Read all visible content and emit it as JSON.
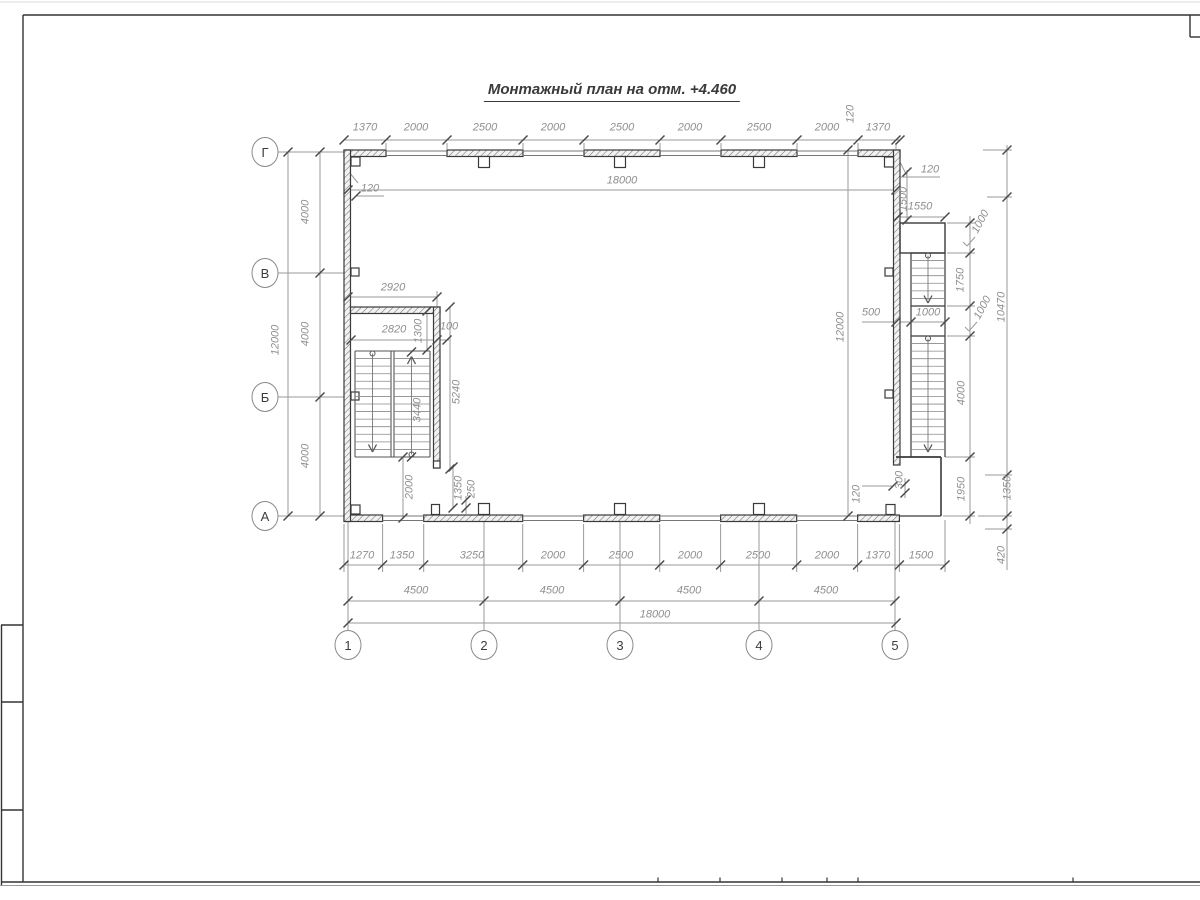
{
  "title": "Монтажный план на отм. +4.460",
  "grid": {
    "columns": [
      {
        "label": "1",
        "x": 348
      },
      {
        "label": "2",
        "x": 484
      },
      {
        "label": "3",
        "x": 620
      },
      {
        "label": "4",
        "x": 759
      },
      {
        "label": "5",
        "x": 895
      }
    ],
    "column_bubble_y": 645,
    "rows": [
      {
        "label": "Г",
        "y": 152
      },
      {
        "label": "В",
        "y": 273
      },
      {
        "label": "Б",
        "y": 397
      },
      {
        "label": "А",
        "y": 516
      }
    ],
    "row_bubble_x": 265
  },
  "dimensions": [
    {
      "text": "1370",
      "x": 365,
      "y": 128,
      "rot": 0
    },
    {
      "text": "2000",
      "x": 416,
      "y": 128,
      "rot": 0
    },
    {
      "text": "2500",
      "x": 485,
      "y": 128,
      "rot": 0
    },
    {
      "text": "2000",
      "x": 553,
      "y": 128,
      "rot": 0
    },
    {
      "text": "2500",
      "x": 622,
      "y": 128,
      "rot": 0
    },
    {
      "text": "2000",
      "x": 690,
      "y": 128,
      "rot": 0
    },
    {
      "text": "2500",
      "x": 759,
      "y": 128,
      "rot": 0
    },
    {
      "text": "2000",
      "x": 827,
      "y": 128,
      "rot": 0
    },
    {
      "text": "120",
      "x": 851,
      "y": 114,
      "rot": -90
    },
    {
      "text": "1370",
      "x": 878,
      "y": 128,
      "rot": 0
    },
    {
      "text": "120",
      "x": 370,
      "y": 189,
      "rot": 0
    },
    {
      "text": "18000",
      "x": 622,
      "y": 181,
      "rot": 0
    },
    {
      "text": "4000",
      "x": 306,
      "y": 212,
      "rot": -90
    },
    {
      "text": "4000",
      "x": 306,
      "y": 334,
      "rot": -90
    },
    {
      "text": "4000",
      "x": 306,
      "y": 456,
      "rot": -90
    },
    {
      "text": "12000",
      "x": 276,
      "y": 340,
      "rot": -90
    },
    {
      "text": "2920",
      "x": 393,
      "y": 288,
      "rot": 0
    },
    {
      "text": "2820",
      "x": 394,
      "y": 330,
      "rot": 0
    },
    {
      "text": "1300",
      "x": 419,
      "y": 331,
      "rot": -90
    },
    {
      "text": "100",
      "x": 449,
      "y": 327,
      "rot": 0
    },
    {
      "text": "5240",
      "x": 457,
      "y": 392,
      "rot": -90
    },
    {
      "text": "3440",
      "x": 418,
      "y": 410,
      "rot": -90
    },
    {
      "text": "2000",
      "x": 410,
      "y": 487,
      "rot": -90
    },
    {
      "text": "1350",
      "x": 459,
      "y": 488,
      "rot": -90
    },
    {
      "text": "250",
      "x": 472,
      "y": 489,
      "rot": -90
    },
    {
      "text": "12000",
      "x": 841,
      "y": 327,
      "rot": -90
    },
    {
      "text": "500",
      "x": 871,
      "y": 313,
      "rot": 0
    },
    {
      "text": "1000",
      "x": 928,
      "y": 313,
      "rot": 0
    },
    {
      "text": "120",
      "x": 930,
      "y": 170,
      "rot": 0
    },
    {
      "text": "1500",
      "x": 904,
      "y": 199,
      "rot": -90
    },
    {
      "text": "1550",
      "x": 920,
      "y": 207,
      "rot": 0
    },
    {
      "text": "1000",
      "x": 981,
      "y": 222,
      "rot": -62
    },
    {
      "text": "1750",
      "x": 961,
      "y": 280,
      "rot": -90
    },
    {
      "text": "1000",
      "x": 983,
      "y": 308,
      "rot": -62
    },
    {
      "text": "4000",
      "x": 962,
      "y": 393,
      "rot": -90
    },
    {
      "text": "1950",
      "x": 962,
      "y": 489,
      "rot": -90
    },
    {
      "text": "300",
      "x": 900,
      "y": 480,
      "rot": -90
    },
    {
      "text": "10470",
      "x": 1002,
      "y": 307,
      "rot": -90
    },
    {
      "text": "1350",
      "x": 1008,
      "y": 488,
      "rot": -90
    },
    {
      "text": "420",
      "x": 1002,
      "y": 555,
      "rot": -90
    },
    {
      "text": "1270",
      "x": 362,
      "y": 556,
      "rot": 0
    },
    {
      "text": "1350",
      "x": 402,
      "y": 556,
      "rot": 0
    },
    {
      "text": "3250",
      "x": 472,
      "y": 556,
      "rot": 0
    },
    {
      "text": "2000",
      "x": 553,
      "y": 556,
      "rot": 0
    },
    {
      "text": "2500",
      "x": 621,
      "y": 556,
      "rot": 0
    },
    {
      "text": "2000",
      "x": 690,
      "y": 556,
      "rot": 0
    },
    {
      "text": "2500",
      "x": 758,
      "y": 556,
      "rot": 0
    },
    {
      "text": "2000",
      "x": 827,
      "y": 556,
      "rot": 0
    },
    {
      "text": "120",
      "x": 857,
      "y": 494,
      "rot": -90
    },
    {
      "text": "1370",
      "x": 878,
      "y": 556,
      "rot": 0
    },
    {
      "text": "1500",
      "x": 921,
      "y": 556,
      "rot": 0
    },
    {
      "text": "4500",
      "x": 416,
      "y": 591,
      "rot": 0
    },
    {
      "text": "4500",
      "x": 552,
      "y": 591,
      "rot": 0
    },
    {
      "text": "4500",
      "x": 689,
      "y": 591,
      "rot": 0
    },
    {
      "text": "4500",
      "x": 826,
      "y": 591,
      "rot": 0
    },
    {
      "text": "18000",
      "x": 655,
      "y": 615,
      "rot": 0
    }
  ],
  "colors": {
    "wall_line": "#3a3a3a",
    "dim_line": "#9a9a9a",
    "dim_text": "#8f8f8f",
    "tick": "#4a4a4a"
  }
}
